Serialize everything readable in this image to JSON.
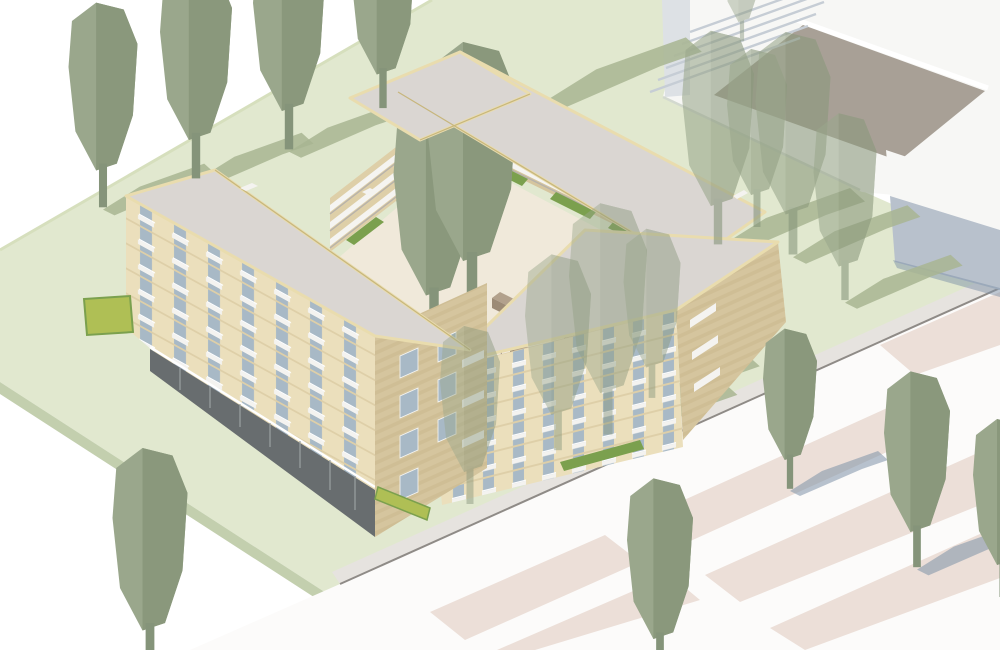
{
  "image": {
    "title": "Courtyard housing block – aerial axonometric visualisation",
    "description": "Architectural rendering of a perimeter apartment block around a landscaped courtyard, set on a lawn with stylised trees, neighbouring white massing buildings and a striped paved street"
  },
  "scene": {
    "lawn_label": "Lawn",
    "street_label": "Paved street with crossing stripes",
    "context_label": "Neighbouring context buildings",
    "block_label": "Courtyard apartment block",
    "courtyard_label": "Inner courtyard with deck access and seating",
    "west_wing_label": "Eight-storey west wing",
    "north_wing_label": "North wing",
    "east_wing_label": "Four-storey south-east wing",
    "trees_label": "Stylised trees"
  },
  "colors": {
    "bg": "#ffffff",
    "lawn": "#e1e8cf",
    "lawnEdge": "#c3cfae",
    "lawnLine": "#d6dfbd",
    "roof": "#dad6d2",
    "parapet": "#e9dcae",
    "parapetLine": "#c7b67c",
    "facadeLit": "#ebdfbc",
    "facadeMid": "#decfa8",
    "facadeShade": "#d5c59e",
    "bandDark": "#c9b78e",
    "win": "#a8b9c6",
    "white": "#f4f3f0",
    "glaze": "#686d6f",
    "glazeLight": "#9aa0a2",
    "paving": "#f0e9da",
    "furn": "#b2a18c",
    "furnDark": "#9c8b76",
    "plant": "#7ba04e",
    "plantYellow": "#afbf55",
    "walk": "#f5f4f1",
    "walkShadow": "#b7b2ab",
    "ctxWhite": "#f7f7f5",
    "ctxShade": "#dde1e5",
    "ctxBlue": "#b8c1cc",
    "ctxDark": "#a8a096",
    "stairLine": "#c6cdd5",
    "road": "#fcfbfa",
    "pink": "#ecdfd8",
    "sidewalk": "#e6e3df",
    "curb": "#8f8b87",
    "tree": "#9aa78c",
    "treeDark": "#8a987c",
    "treeCourt": "#8e9e81",
    "treeCourtDark": "#7f8f72",
    "trunk": "#85947a",
    "shGrass": "#a8b592",
    "shPlaza": "#7e91a8"
  }
}
